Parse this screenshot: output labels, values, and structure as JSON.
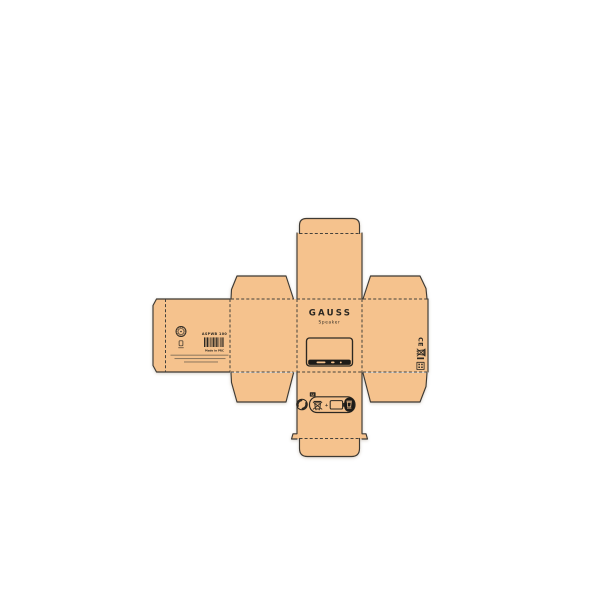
{
  "canvas": {
    "background": "#ffffff",
    "board_color": "#F5C28D",
    "line_color": "#3E3A34",
    "ink_color": "#2C2822"
  },
  "front_panel": {
    "brand": "GAUSS",
    "product_type": "Speaker",
    "window": {
      "display_dashes": 3
    }
  },
  "back_panel": {
    "sku_label": "ASPWB 100",
    "origin_label": "Made in PRC",
    "barcode_pattern": [
      2,
      1,
      1,
      1,
      2,
      1,
      1,
      2,
      1,
      1,
      1,
      1,
      2,
      1,
      1,
      1,
      2,
      1,
      1,
      1,
      1,
      2,
      1,
      1,
      2,
      1,
      1,
      2
    ],
    "fine_print_lines": 3,
    "icons": [
      "certification-seal-icon",
      "age-mark-icon",
      "barcode-icon"
    ]
  },
  "right_side_panel": {
    "ce_mark": "CE",
    "icons": [
      "ce-mark",
      "weee-bin-icon",
      "collection-bar-icon",
      "recycling-code-icon"
    ]
  },
  "bottom_panel": {
    "battery_chemistry_label": "Li",
    "plus_label": "+",
    "icons": [
      "green-dot-icon",
      "weee-bin-icon",
      "battery-icon",
      "battery-directive-black-icon"
    ]
  }
}
